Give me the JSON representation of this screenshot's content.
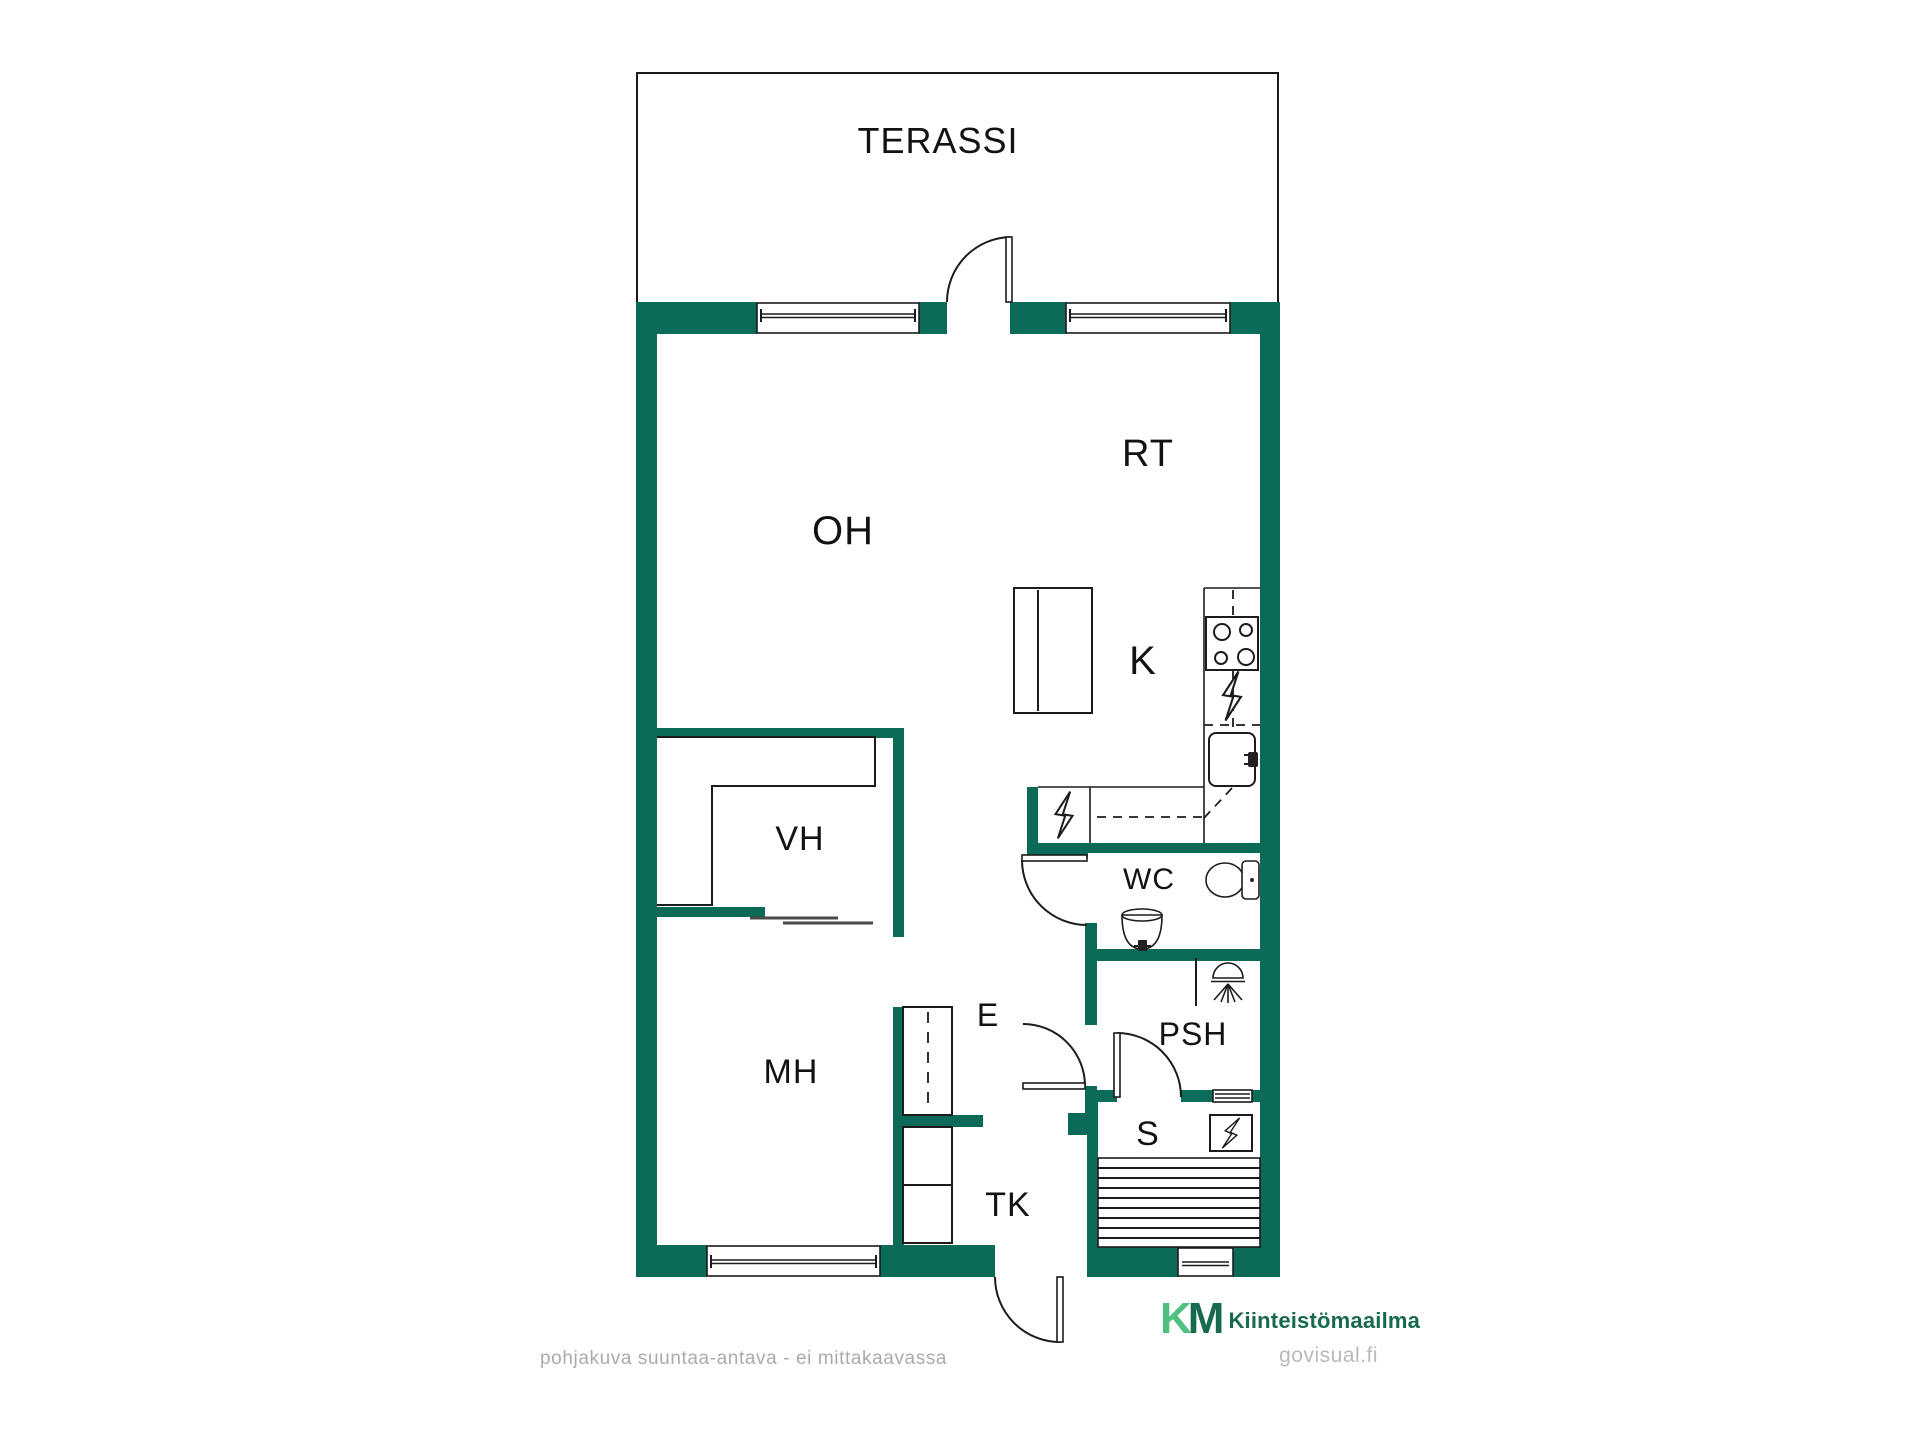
{
  "page": {
    "type": "floor-plan",
    "background": "#ffffff"
  },
  "colors": {
    "wall": "#0c6a58",
    "logo-light": "#4ec07f",
    "logo-dark": "#17694f",
    "muted": "#ababab",
    "watermark": "#b9b9b9",
    "line": "#1c1c1c"
  },
  "rooms": [
    {
      "id": "terassi",
      "label": "TERASSI",
      "meaning": "terrace"
    },
    {
      "id": "oh",
      "label": "OH",
      "meaning": "living-room"
    },
    {
      "id": "rt",
      "label": "RT",
      "meaning": "dining-area"
    },
    {
      "id": "k",
      "label": "K",
      "meaning": "kitchen"
    },
    {
      "id": "vh",
      "label": "VH",
      "meaning": "walk-in-closet"
    },
    {
      "id": "wc",
      "label": "WC",
      "meaning": "toilet"
    },
    {
      "id": "mh",
      "label": "MH",
      "meaning": "bedroom"
    },
    {
      "id": "e",
      "label": "E",
      "meaning": "hallway"
    },
    {
      "id": "psh",
      "label": "PSH",
      "meaning": "washroom"
    },
    {
      "id": "s",
      "label": "S",
      "meaning": "sauna"
    },
    {
      "id": "tk",
      "label": "TK",
      "meaning": "entry-porch"
    }
  ],
  "icons": [
    "stove-icon",
    "sink-icon",
    "dishwasher-bolt-icon",
    "fridge-bolt-icon",
    "toilet-icon",
    "washbasin-icon",
    "shower-icon",
    "sauna-heater-icon",
    "sauna-bench-icon",
    "wardrobe-icon",
    "sliding-door-icon",
    "door-swing-icon",
    "window-icon"
  ],
  "branding": {
    "logo_k": "K",
    "logo_m": "M",
    "company": "Kiinteistömaailma",
    "watermark": "govisual.fi"
  },
  "footer": {
    "disclaimer": "pohjakuva suuntaa-antava - ei mittakaavassa"
  }
}
